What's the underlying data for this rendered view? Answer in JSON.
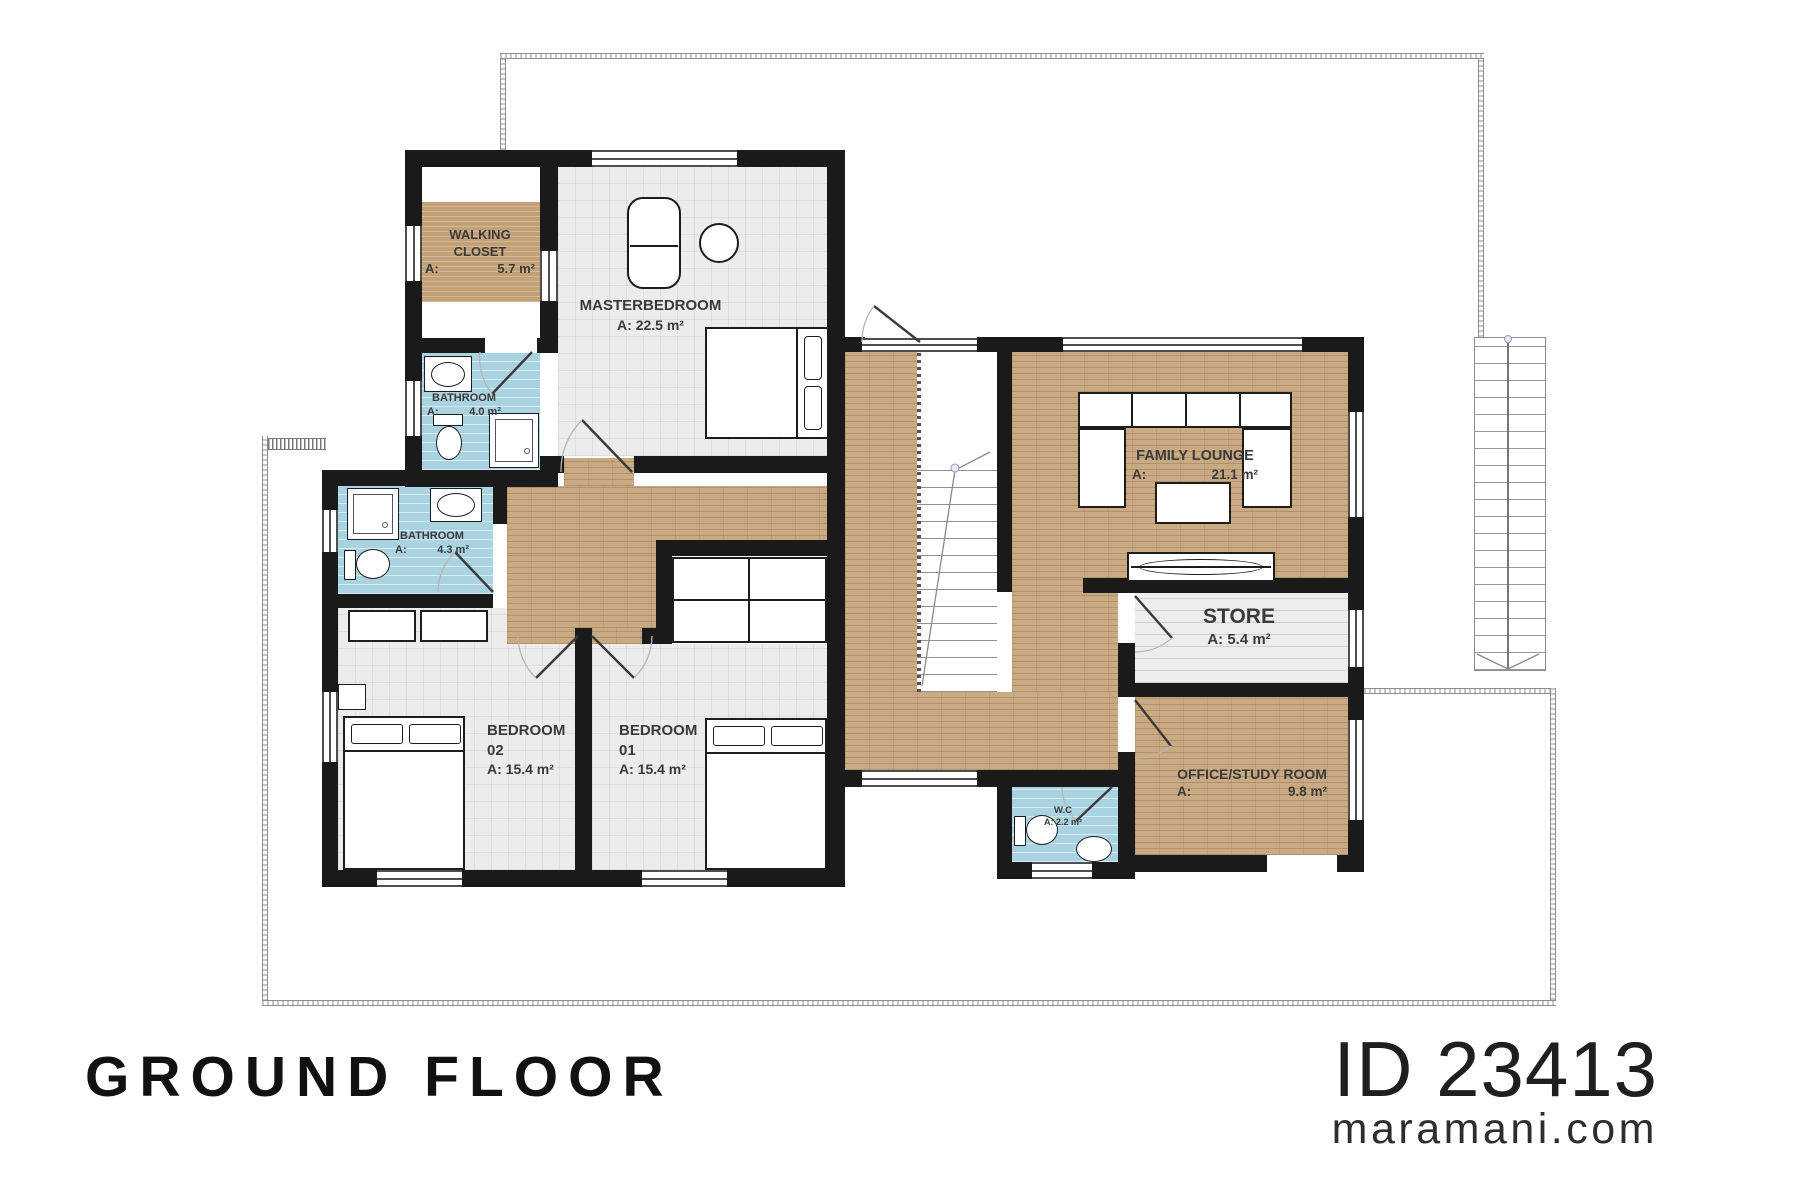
{
  "footer": {
    "floor_label": "GROUND FLOOR",
    "plan_id": "ID 23413",
    "website": "maramani.com"
  },
  "rooms": {
    "walking_closet": {
      "name": "WALKING CLOSET",
      "area_label": "A:",
      "area_value": "5.7 m²"
    },
    "masterbedroom": {
      "name": "MASTERBEDROOM",
      "area_label": "A:",
      "area_value": "22.5 m²"
    },
    "bathroom_top": {
      "name": "BATHROOM",
      "area_label": "A:",
      "area_value": "4.0 m²"
    },
    "bathroom_mid": {
      "name": "BATHROOM",
      "area_label": "A:",
      "area_value": "4.3 m²"
    },
    "bedroom_02": {
      "name": "BEDROOM",
      "number": "02",
      "area_label": "A:",
      "area_value": "15.4 m²"
    },
    "bedroom_01": {
      "name": "BEDROOM",
      "number": "01",
      "area_label": "A:",
      "area_value": "15.4 m²"
    },
    "family_lounge": {
      "name": "FAMILY LOUNGE",
      "area_label": "A:",
      "area_value": "21.1 m²"
    },
    "store": {
      "name": "STORE",
      "area_label": "A:",
      "area_value": "5.4 m²"
    },
    "office": {
      "name": "OFFICE/STUDY ROOM",
      "area_label": "A:",
      "area_value": "9.8 m²"
    },
    "wc": {
      "name": "W.C",
      "area_label": "A:",
      "area_value": "2.2 m²"
    }
  },
  "colors": {
    "wall": "#1a1a1a",
    "wood_floor": "#c9aa82",
    "tile_floor": "#ececec",
    "bath_floor": "#aad3e1",
    "outline": "#8d8d8d"
  }
}
